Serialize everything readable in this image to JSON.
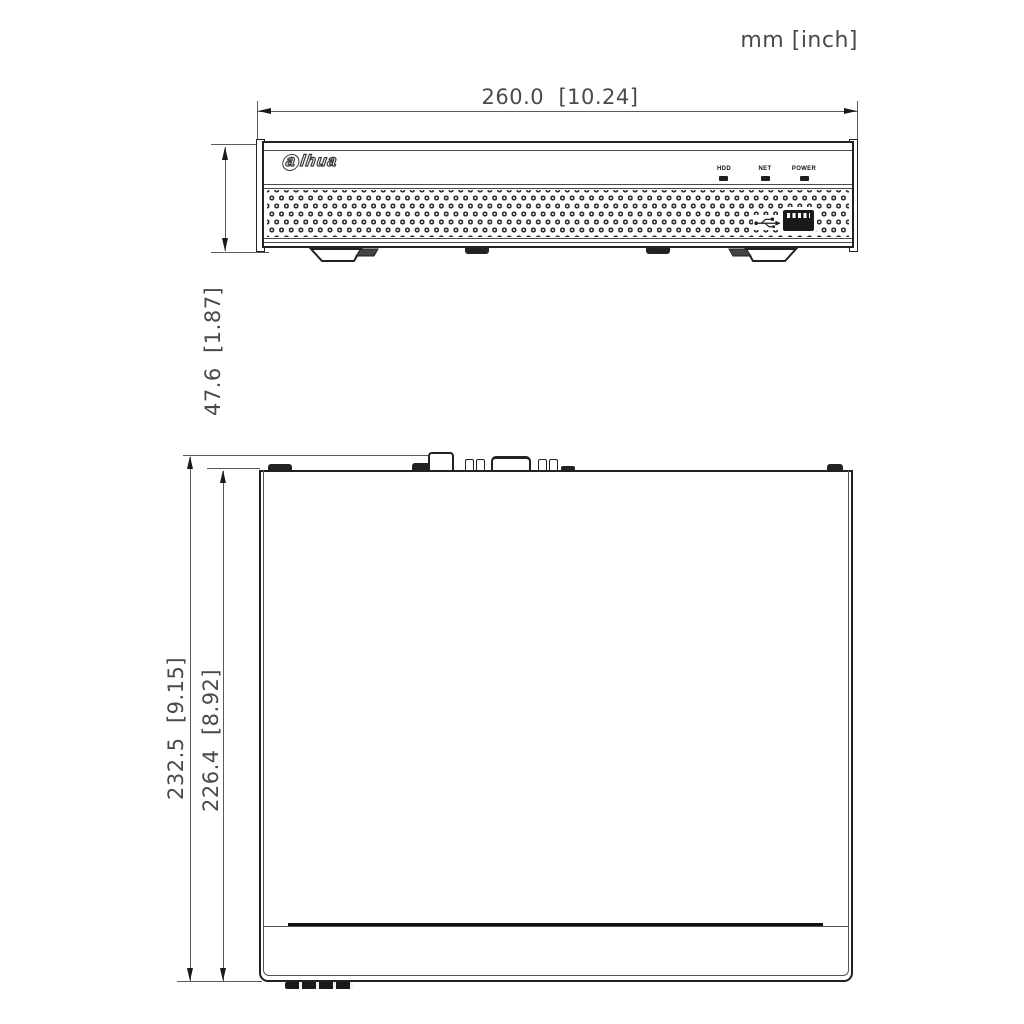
{
  "units_label": "mm [inch]",
  "dimensions": {
    "front_width": "260.0  [10.24]",
    "front_height": "47.6  [1.87]",
    "top_depth_outer": "232.5  [9.15]",
    "top_depth_inner": "226.4  [8.92]"
  },
  "front_view": {
    "logo_first": "a",
    "logo_rest": "lhua",
    "led_labels": [
      "HDD",
      "NET",
      "POWER"
    ]
  },
  "icons": {
    "usb": "usb-trident-icon"
  },
  "colors": {
    "outline": "#222222",
    "dim_line": "#5a5a5a",
    "dim_text": "#4a4a4a"
  }
}
